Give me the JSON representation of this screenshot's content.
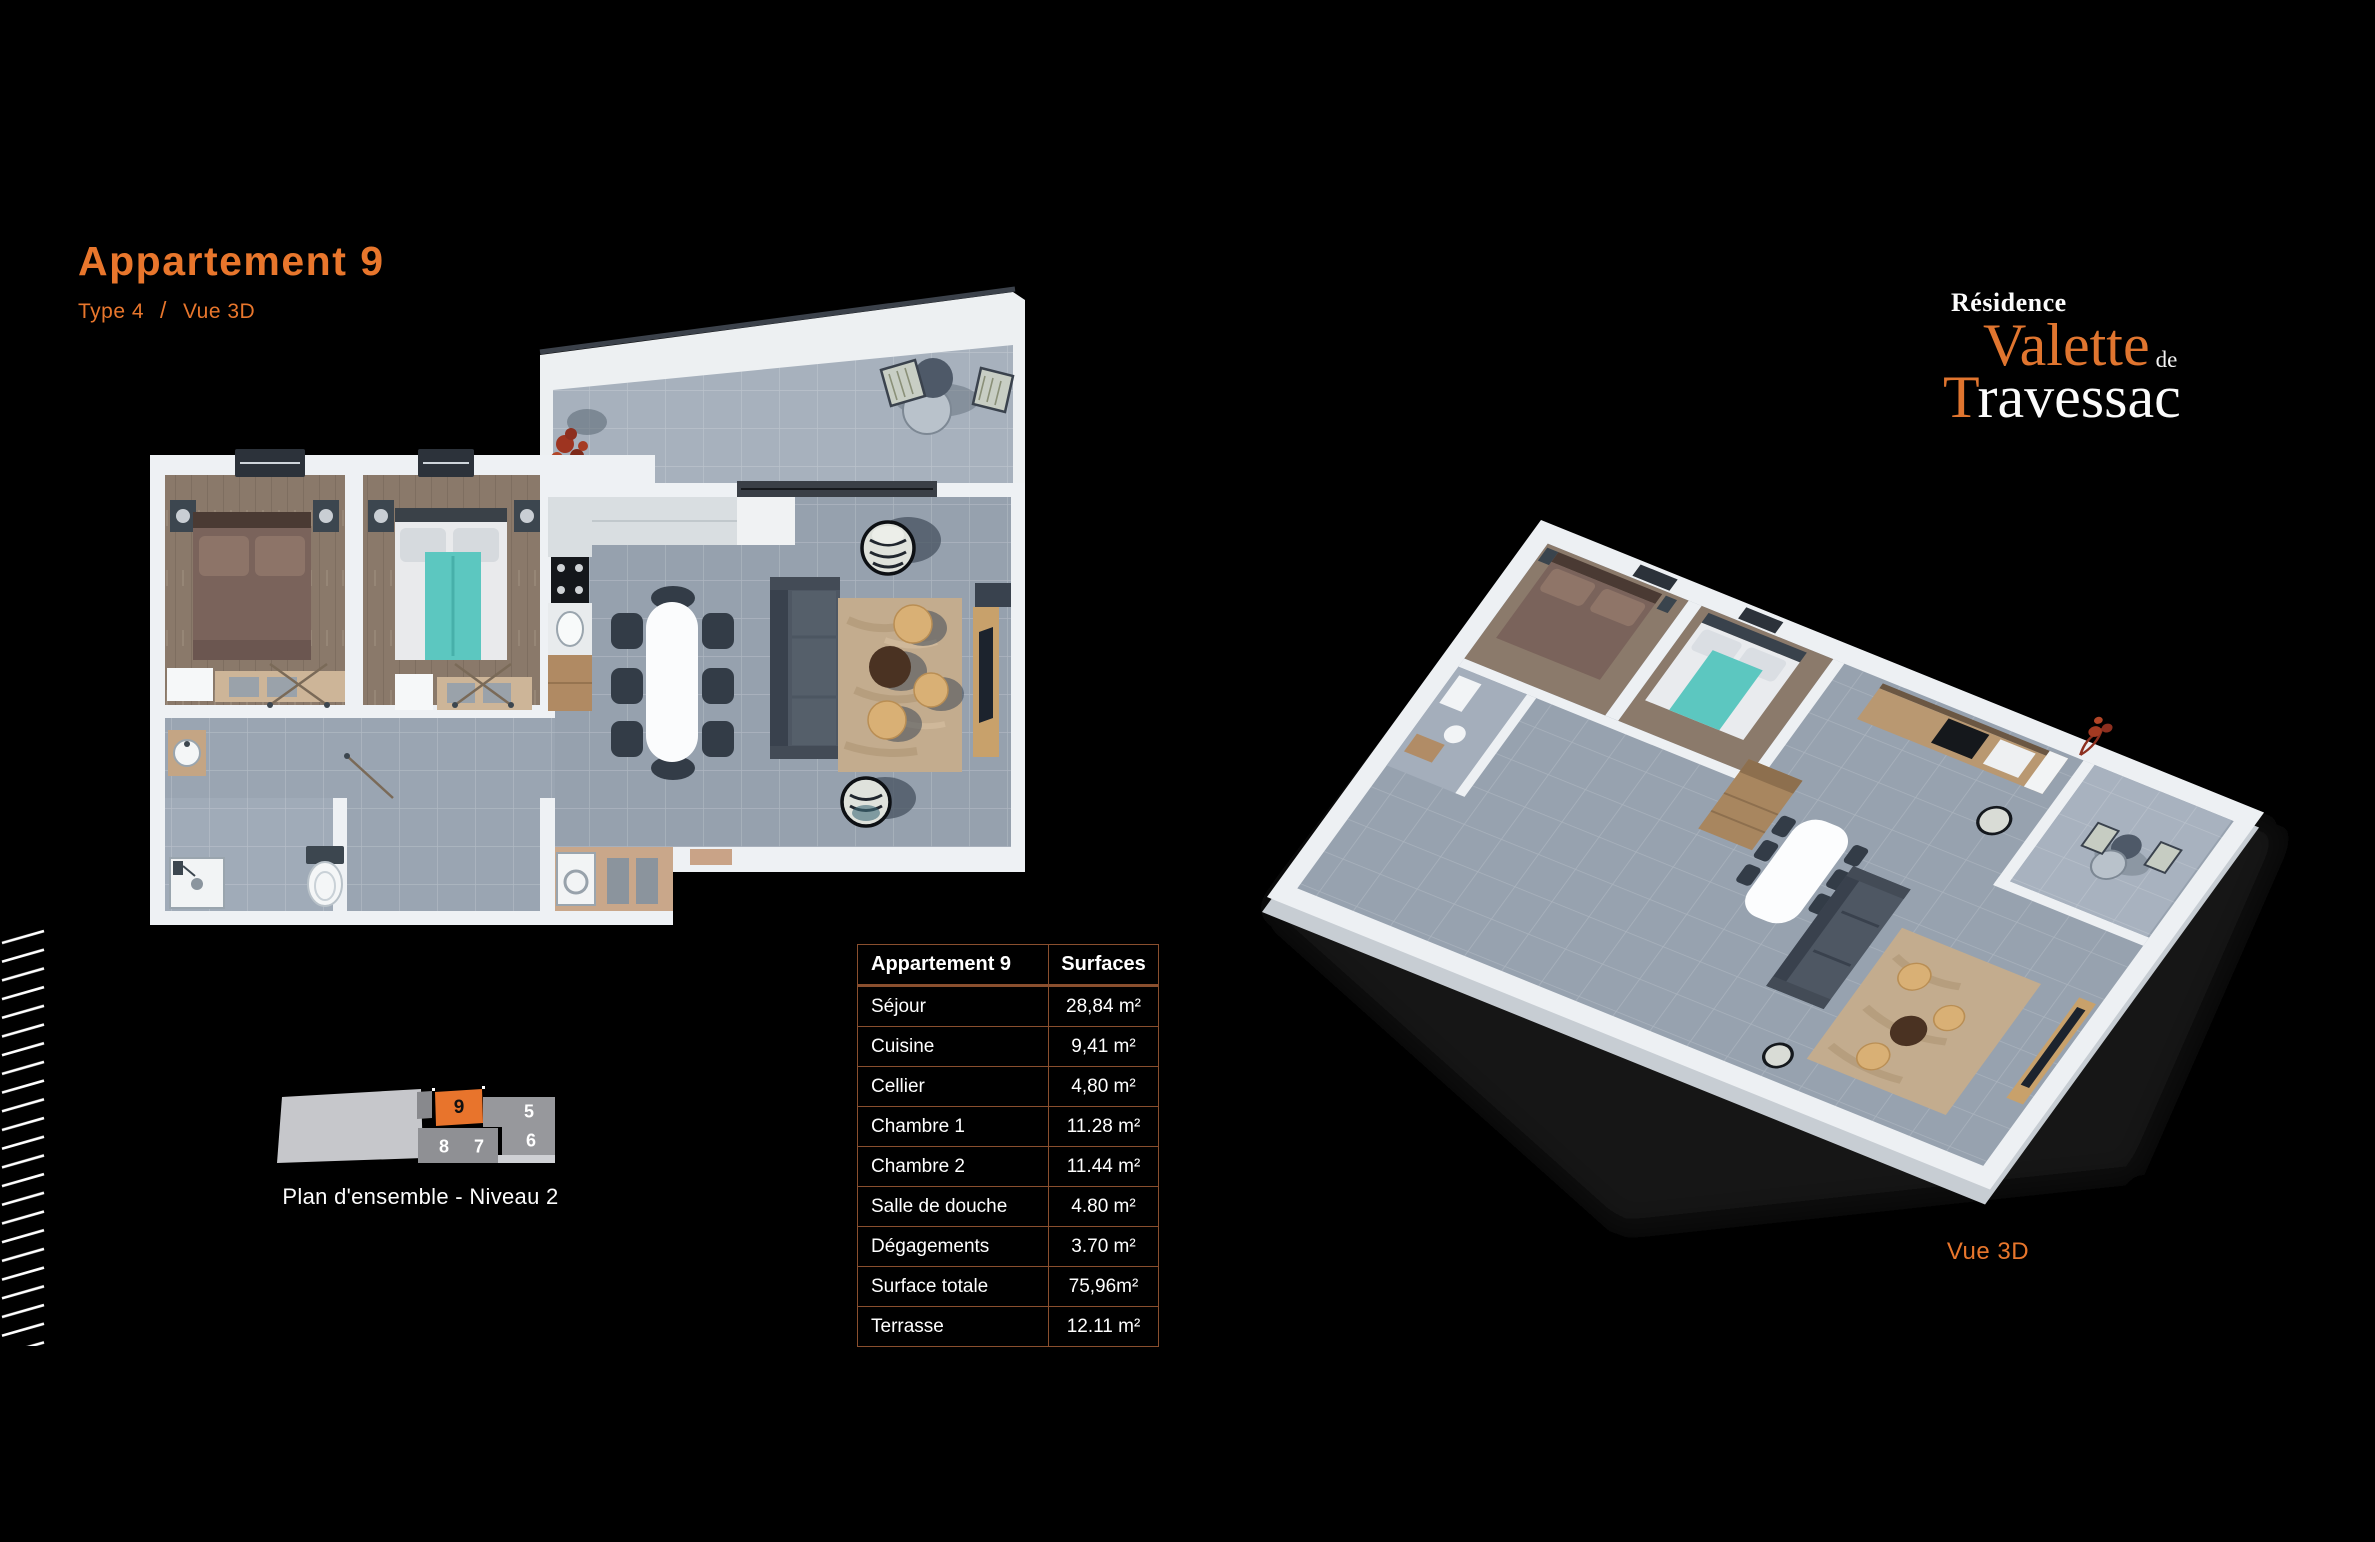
{
  "header": {
    "title": "Appartement 9",
    "type_label": "Type 4",
    "separator": "/",
    "view_label": "Vue 3D"
  },
  "brand": {
    "line1": "Résidence",
    "name1": "Valette",
    "de": "de",
    "name2_initial": "T",
    "name2_rest": "ravessac"
  },
  "surfaces_table": {
    "header": [
      "Appartement 9",
      "Surfaces"
    ],
    "rows": [
      [
        "Séjour",
        "28,84 m²"
      ],
      [
        "Cuisine",
        "9,41 m²"
      ],
      [
        "Cellier",
        "4,80 m²"
      ],
      [
        "Chambre 1",
        "11.28 m²"
      ],
      [
        "Chambre 2",
        "11.44 m²"
      ],
      [
        "Salle de douche",
        "4.80 m²"
      ],
      [
        "Dégagements",
        "3.70 m²"
      ],
      [
        "Surface totale",
        "75,96m²"
      ],
      [
        "Terrasse",
        "12.11 m²"
      ]
    ]
  },
  "plan_overview": {
    "caption": "Plan d'ensemble - Niveau 2",
    "units": [
      {
        "label": "9",
        "highlighted": true
      },
      {
        "label": "5",
        "highlighted": false
      },
      {
        "label": "6",
        "highlighted": false
      },
      {
        "label": "7",
        "highlighted": false
      },
      {
        "label": "8",
        "highlighted": false
      }
    ]
  },
  "view3d": {
    "caption": "Vue 3D"
  },
  "colors": {
    "accent_orange": "#e8762c",
    "table_border": "#8a4f2e",
    "unit_highlight": "#e8742c",
    "background": "#000000"
  }
}
